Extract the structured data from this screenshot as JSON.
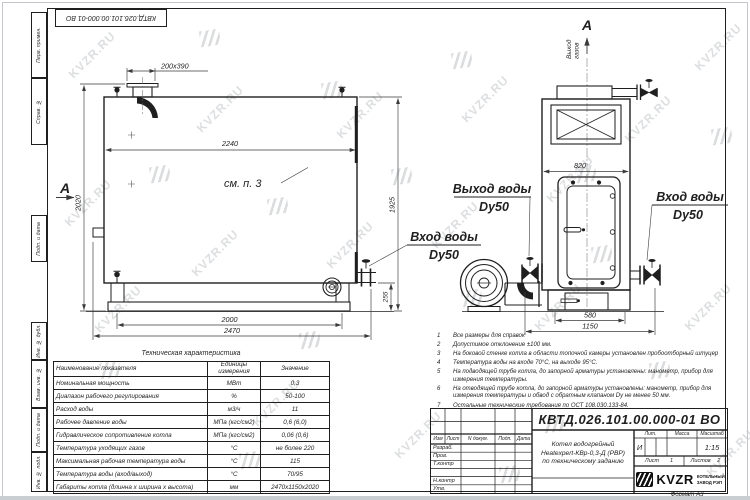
{
  "sheet": {
    "stamp_top": "КВТД.026.101.00.000-01 ВО",
    "format_label": "Формат А3",
    "margin_cells": [
      "Перв. примен.",
      "Справ. №",
      "Подп. и дата",
      "Инв. № дубл.",
      "Взам. инв. №",
      "Подп. и дата",
      "Инв. № подл."
    ]
  },
  "watermark": {
    "text": "KVZR.RU"
  },
  "drawing": {
    "section_label_left": "А",
    "section_label_top": "А",
    "note_ref": "см. п. 3",
    "gas_out_line1": "Выход",
    "gas_out_line2": "газов",
    "label_water_out": "Выход воды",
    "label_water_out_dn": "Dy50",
    "label_water_in_mid": "Вход воды",
    "label_water_in_mid_dn": "Dy50",
    "label_water_in_right": "Вход воды",
    "label_water_in_right_dn": "Dy50",
    "dims": {
      "w_stub": "200х390",
      "w_top": "2240",
      "h_left": "2020",
      "h_right": "1925",
      "w_base": "2000",
      "w_overall": "2470",
      "h_skid": "255",
      "w_front": "820",
      "w_front_base": "580",
      "w_front_overall": "1150"
    }
  },
  "spec_table": {
    "title": "Техническая характеристика",
    "col1": "Наименование показателя",
    "col2": "Единицы измерения",
    "col3": "Значение",
    "rows": [
      {
        "name": "Номинальная мощность",
        "unit": "МВт",
        "value": "0,3"
      },
      {
        "name": "Диапазон рабочего регулирования",
        "unit": "%",
        "value": "50-100"
      },
      {
        "name": "Расход воды",
        "unit": "м3/ч",
        "value": "11"
      },
      {
        "name": "Рабочее давление воды",
        "unit": "МПа (кгс/см2)",
        "value": "0,6 (6,0)"
      },
      {
        "name": "Гидравлическое сопротивление котла",
        "unit": "МПа (кгс/см2)",
        "value": "0,06 (0,6)"
      },
      {
        "name": "Температура уходящих газов",
        "unit": "°С",
        "value": "не более 220"
      },
      {
        "name": "Максимальная рабочая температура воды",
        "unit": "°С",
        "value": "115"
      },
      {
        "name": "Температура воды (вход/выход)",
        "unit": "°С",
        "value": "70/95"
      },
      {
        "name": "Габариты котла (длинна х ширина х высота)",
        "unit": "мм",
        "value": "2470х1150х2020"
      }
    ]
  },
  "notes": [
    {
      "n": "1",
      "text": "Все размеры для справок"
    },
    {
      "n": "2",
      "text": "Допустимое отклонение ±100 мм."
    },
    {
      "n": "3",
      "text": "На боковой стенке котла в области топочной камеры установлен пробоотборный штуцер"
    },
    {
      "n": "4",
      "text": "Температура воды на входе 70°С, на выходе 95°С."
    },
    {
      "n": "5",
      "text": "На подводящей трубе котла, до запорной арматуры установлены: манометр, прибор для измерения температуры."
    },
    {
      "n": "6",
      "text": "На отводящей трубе котла, до запорной арматуры установлены: манометр, прибор для измерения температуры и обвод с обратным клапаном Dу не менее 50 мм."
    },
    {
      "n": "7",
      "text": "Остальные технические требования по ОСТ 108.030.133-84."
    }
  ],
  "title_block": {
    "doc_number": "КВТД.026.101.00.000-01 ВО",
    "cols": [
      "Изм",
      "Лист",
      "N докум.",
      "Подп.",
      "Дата"
    ],
    "sig_rows": [
      "Разраб.",
      "Пров.",
      "Т.контр",
      "",
      "Н.контр",
      "Утв."
    ],
    "product_lines": [
      "Котел водогрейный",
      "Heatexpert-КВр-0,3-Д (РВР)",
      "по техническому заданию"
    ],
    "lit_label": "Лит.",
    "mass_label": "Масса",
    "scale_label": "Масштаб",
    "lit_value": "И",
    "scale_value": "1:15",
    "sheet_label": "Лист",
    "sheet_value": "1",
    "sheets_label": "Листов",
    "sheets_value": "2",
    "logo_text": "KVZR",
    "logo_sub1": "КОТЕЛЬНЫЙ",
    "logo_sub2": "ЗАВОД РЭП"
  }
}
